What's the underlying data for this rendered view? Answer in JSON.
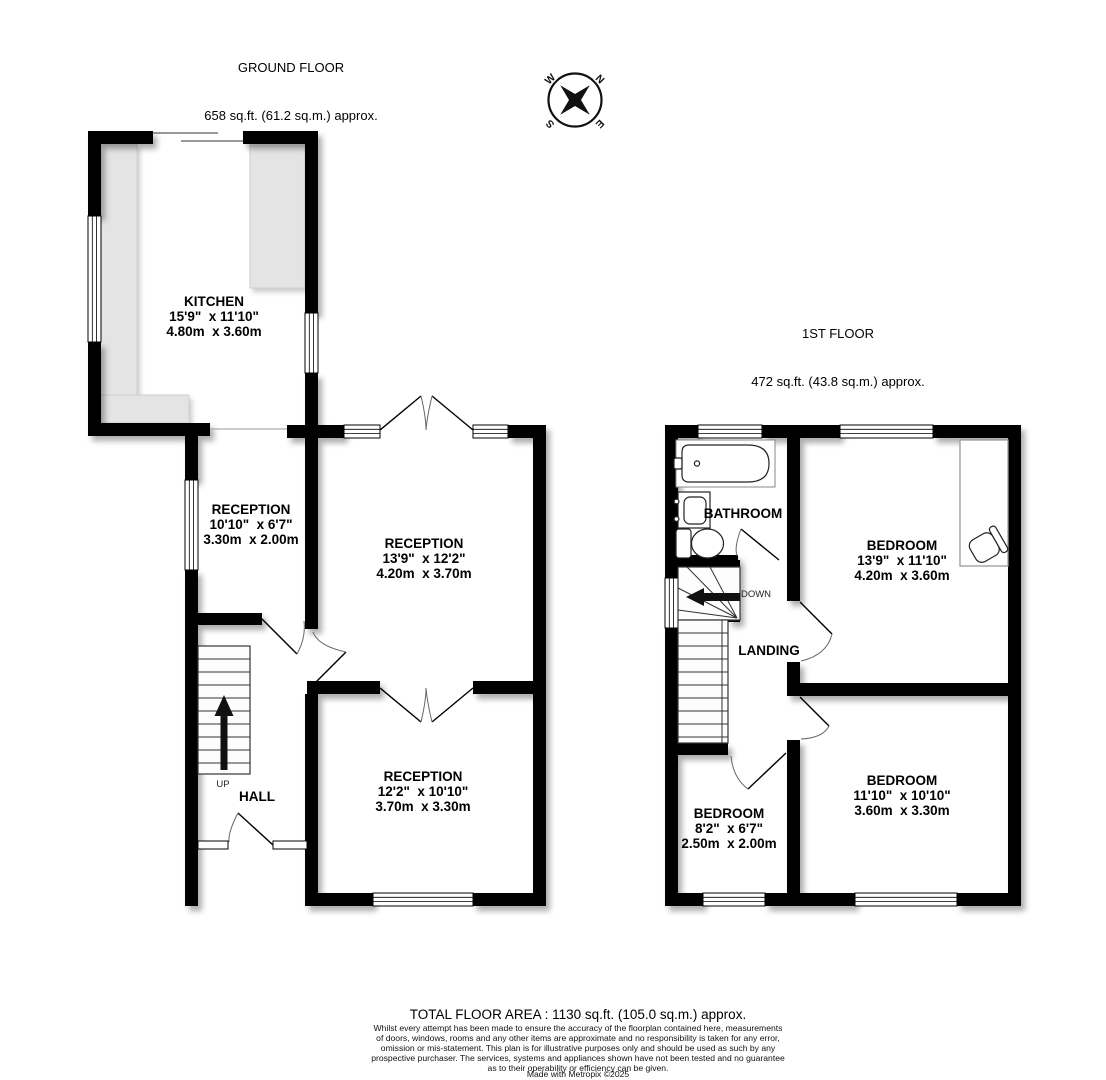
{
  "ground_floor": {
    "title": "GROUND FLOOR",
    "area": "658 sq.ft. (61.2 sq.m.) approx."
  },
  "first_floor": {
    "title": "1ST FLOOR",
    "area": "472 sq.ft. (43.8 sq.m.) approx."
  },
  "rooms": {
    "kitchen": "KITCHEN\n15'9\"  x 11'10\"\n4.80m  x 3.60m",
    "reception_left": "RECEPTION\n10'10\"  x 6'7\"\n3.30m  x 2.00m",
    "reception_middle": "RECEPTION\n13'9\"  x 12'2\"\n4.20m  x 3.70m",
    "reception_bottom": "RECEPTION\n12'2\"  x 10'10\"\n3.70m  x 3.30m",
    "hall": "HALL",
    "bathroom": "BATHROOM",
    "landing": "LANDING",
    "bedroom_large": "BEDROOM\n13'9\"  x 11'10\"\n4.20m  x 3.60m",
    "bedroom_rear": "BEDROOM\n11'10\"  x 10'10\"\n3.60m  x 3.30m",
    "bedroom_small": "BEDROOM\n8'2\"  x 6'7\"\n2.50m  x 2.00m"
  },
  "stairs": {
    "up": "UP",
    "down": "DOWN"
  },
  "compass": {
    "n": "N",
    "e": "E",
    "s": "S",
    "w": "W"
  },
  "footer": {
    "total_area": "TOTAL FLOOR AREA : 1130 sq.ft. (105.0 sq.m.) approx.",
    "disclaimer": "Whilst every attempt has been made to ensure the accuracy of the floorplan contained here, measurements\nof doors, windows, rooms and any other items are approximate and no responsibility is taken for any error,\nomission or mis-statement. This plan is for illustrative purposes only and should be used as such by any\nprospective purchaser. The services, systems and appliances shown have not been tested and no guarantee\nas to their operability or efficiency can be given.",
    "credit": "Made with Metropix ©2025"
  },
  "colors": {
    "wall": "#000000",
    "counter": "#e4e4e4",
    "background": "#ffffff"
  }
}
